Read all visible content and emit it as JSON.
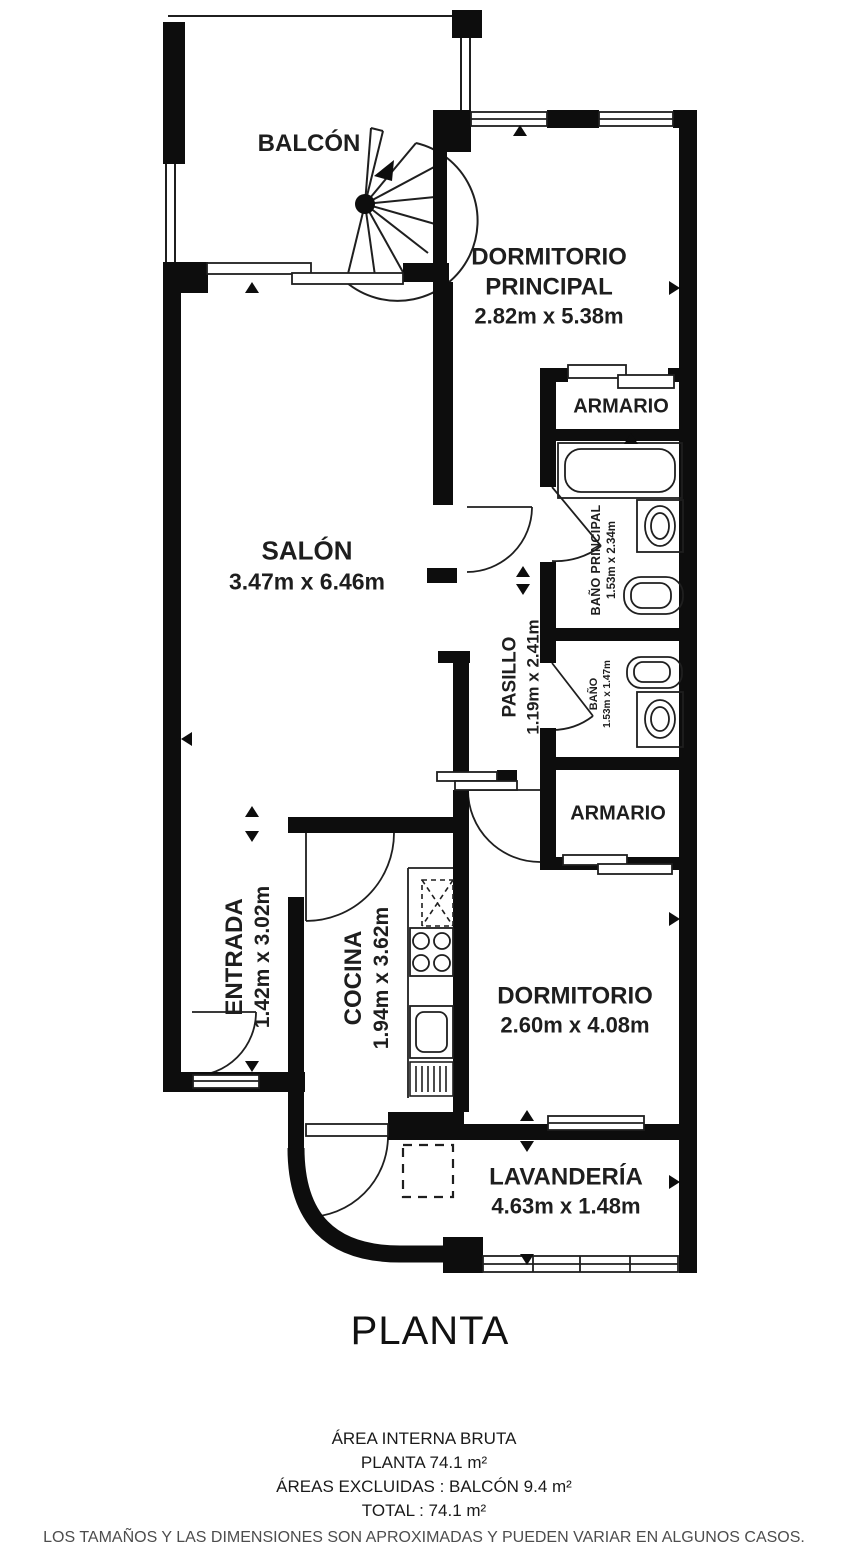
{
  "title": "PLANTA",
  "plan": {
    "balcony": {
      "name": "BALCÓN"
    },
    "master_bedroom": {
      "name_line1": "DORMITORIO",
      "name_line2": "PRINCIPAL",
      "dims": "2.82m x 5.38m"
    },
    "wardrobe_top": {
      "name": "ARMARIO"
    },
    "master_bathroom": {
      "name": "BAÑO PRINCIPAL",
      "dims": "1.53m x 2.34m"
    },
    "living_room": {
      "name": "SALÓN",
      "dims": "3.47m x 6.46m"
    },
    "hallway": {
      "name": "PASILLO",
      "dims": "1.19m x 2.41m"
    },
    "bathroom": {
      "name": "BAÑO",
      "dims": "1.53m x 1.47m"
    },
    "wardrobe_bottom": {
      "name": "ARMARIO"
    },
    "entrance": {
      "name": "ENTRADA",
      "dims": "1.42m x 3.02m"
    },
    "kitchen": {
      "name": "COCINA",
      "dims": "1.94m x 3.62m"
    },
    "bedroom": {
      "name": "DORMITORIO",
      "dims": "2.60m x 4.08m"
    },
    "laundry": {
      "name": "LAVANDERÍA",
      "dims": "4.63m x 1.48m"
    }
  },
  "summary": {
    "line1": "ÁREA INTERNA BRUTA",
    "line2": "PLANTA 74.1 m²",
    "line3": "ÁREAS EXCLUIDAS :  BALCÓN 9.4 m²",
    "line4": "TOTAL :  74.1 m²",
    "disclaimer": "LOS TAMAÑOS Y LAS DIMENSIONES SON APROXIMADAS Y PUEDEN VARIAR EN ALGUNOS CASOS."
  },
  "colors": {
    "wall": "#0d0d0d",
    "text": "#1e1e1e",
    "disclaimer": "#4d4d4d",
    "background": "#ffffff"
  }
}
